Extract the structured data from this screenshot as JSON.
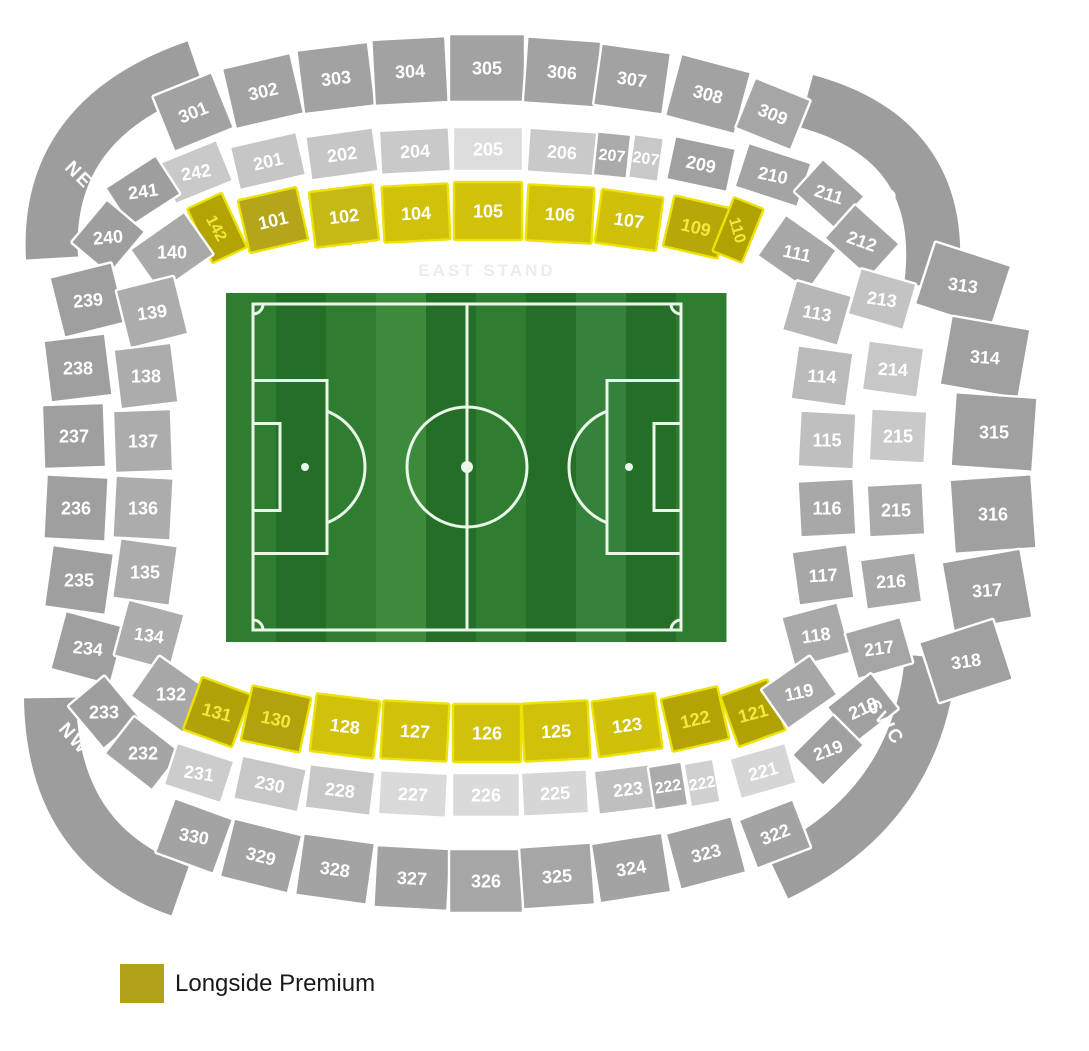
{
  "legend": {
    "label": "Longside Premium",
    "color": "#b2a219"
  },
  "stand_label": {
    "text": "EAST STAND",
    "x": 487,
    "y": 276,
    "color": "#ececec"
  },
  "palette": {
    "background": "#ffffff",
    "divider": "#ffffff",
    "section_text": "#ffffff",
    "yellow_bright": "#d0c10b",
    "yellow_dark": "#b1a204",
    "yellow_stroke": "#ece205",
    "yellow_text": "#f3e83c",
    "corner_band": "#9d9d9d"
  },
  "corner_labels": [
    {
      "label": "NEC",
      "x": 85,
      "y": 180,
      "r": 45
    },
    {
      "label": "SEC",
      "x": 880,
      "y": 185,
      "r": 50
    },
    {
      "label": "NWC",
      "x": 80,
      "y": 744,
      "r": 48
    },
    {
      "label": "SWC",
      "x": 886,
      "y": 722,
      "r": 55
    }
  ],
  "corner_bands": [
    {
      "name": "NEC",
      "d": "M 52 258 Q 44 118 196 66",
      "w": 52
    },
    {
      "name": "SEC",
      "d": "M 806 101 Q 950 140 931 287",
      "w": 54
    },
    {
      "name": "NWC",
      "d": "M 50 698 Q 52 846 180 891",
      "w": 52
    },
    {
      "name": "SWC",
      "d": "M 931 657 Q 918 808 777 875",
      "w": 52
    }
  ],
  "sections_columns": [
    "label",
    "x",
    "y",
    "w",
    "h",
    "rot",
    "label_rot",
    "fill",
    "cls"
  ],
  "sections": [
    [
      "301",
      193,
      112,
      64,
      60,
      -22,
      -22,
      "#a2a2a2",
      "gray"
    ],
    [
      "302",
      263,
      91,
      70,
      62,
      -13,
      -13,
      "#a2a2a2",
      "gray"
    ],
    [
      "303",
      336,
      78,
      72,
      64,
      -7,
      -7,
      "#a2a2a2",
      "gray"
    ],
    [
      "304",
      410,
      71,
      74,
      66,
      -3,
      -3,
      "#a2a2a2",
      "gray"
    ],
    [
      "305",
      487,
      68,
      76,
      68,
      0,
      0,
      "#a2a2a2",
      "gray"
    ],
    [
      "306",
      562,
      72,
      74,
      66,
      4,
      4,
      "#a2a2a2",
      "gray"
    ],
    [
      "307",
      632,
      79,
      70,
      62,
      8,
      8,
      "#a2a2a2",
      "gray"
    ],
    [
      "308",
      708,
      94,
      72,
      64,
      15,
      15,
      "#a2a2a2",
      "gray"
    ],
    [
      "309",
      773,
      114,
      60,
      54,
      22,
      22,
      "#a6a6a6",
      "gray"
    ],
    [
      "242",
      196,
      172,
      62,
      44,
      -22,
      -10,
      "#c9c9c9",
      "gray"
    ],
    [
      "201",
      268,
      161,
      68,
      44,
      -13,
      -13,
      "#c6c6c6",
      "gray"
    ],
    [
      "202",
      342,
      154,
      68,
      44,
      -8,
      -8,
      "#c6c6c6",
      "gray"
    ],
    [
      "204",
      415,
      151,
      70,
      44,
      -3,
      -3,
      "#c9c9c9",
      "gray"
    ],
    [
      "205",
      488,
      149,
      70,
      44,
      0,
      0,
      "#dcdcdc",
      "gray"
    ],
    [
      "206",
      562,
      152,
      68,
      44,
      4,
      4,
      "#c9c9c9",
      "gray"
    ],
    [
      "207",
      612,
      155,
      34,
      44,
      6,
      6,
      "#aaaaaa",
      "gray"
    ],
    [
      "207",
      646,
      158,
      30,
      44,
      8,
      8,
      "#c8c8c8",
      "gray"
    ],
    [
      "209",
      701,
      164,
      62,
      44,
      12,
      12,
      "#a0a0a0",
      "gray"
    ],
    [
      "210",
      773,
      175,
      66,
      46,
      18,
      12,
      "#a4a4a4",
      "gray"
    ],
    [
      "211",
      829,
      194,
      56,
      44,
      42,
      18,
      "#a4a4a4",
      "gray"
    ],
    [
      "142",
      217,
      228,
      38,
      60,
      -25,
      62,
      "#b3a404",
      "ylwd"
    ],
    [
      "101",
      273,
      220,
      60,
      54,
      -13,
      -13,
      "#b4a51a",
      "ylw"
    ],
    [
      "102",
      344,
      216,
      64,
      56,
      -7,
      -7,
      "#c6b815",
      "ylw"
    ],
    [
      "104",
      416,
      213,
      66,
      56,
      -3,
      -3,
      "#d0c10b",
      "ylw"
    ],
    [
      "105",
      488,
      211,
      68,
      58,
      0,
      0,
      "#d0c10b",
      "ylw"
    ],
    [
      "106",
      560,
      214,
      66,
      56,
      3,
      3,
      "#d0c10b",
      "ylw"
    ],
    [
      "107",
      629,
      220,
      62,
      54,
      8,
      8,
      "#cfc009",
      "ylw"
    ],
    [
      "109",
      696,
      227,
      56,
      52,
      13,
      13,
      "#b7a808",
      "ylwd"
    ],
    [
      "110",
      738,
      230,
      32,
      58,
      22,
      74,
      "#b1a204",
      "ylwd"
    ],
    [
      "241",
      143,
      191,
      60,
      46,
      -33,
      -8,
      "#9e9e9e",
      "gray"
    ],
    [
      "240",
      108,
      237,
      56,
      50,
      -50,
      -5,
      "#9e9e9e",
      "gray"
    ],
    [
      "140",
      172,
      252,
      66,
      52,
      -35,
      0,
      "#a9a9a9",
      "gray"
    ],
    [
      "239",
      88,
      300,
      64,
      62,
      -14,
      -5,
      "#9f9f9f",
      "gray"
    ],
    [
      "139",
      152,
      312,
      60,
      60,
      -14,
      -8,
      "#acacac",
      "gray"
    ],
    [
      "238",
      78,
      368,
      62,
      62,
      -7,
      0,
      "#9f9f9f",
      "gray"
    ],
    [
      "138",
      146,
      376,
      58,
      60,
      -7,
      0,
      "#acacac",
      "gray"
    ],
    [
      "237",
      74,
      436,
      62,
      64,
      -2,
      0,
      "#9f9f9f",
      "gray"
    ],
    [
      "137",
      143,
      441,
      58,
      62,
      -2,
      0,
      "#acacac",
      "gray"
    ],
    [
      "236",
      76,
      508,
      62,
      64,
      3,
      0,
      "#9f9f9f",
      "gray"
    ],
    [
      "136",
      143,
      508,
      58,
      62,
      3,
      0,
      "#acacac",
      "gray"
    ],
    [
      "235",
      79,
      580,
      62,
      62,
      8,
      0,
      "#9f9f9f",
      "gray"
    ],
    [
      "135",
      145,
      572,
      58,
      60,
      8,
      0,
      "#acacac",
      "gray"
    ],
    [
      "234",
      88,
      648,
      62,
      60,
      15,
      6,
      "#9f9f9f",
      "gray"
    ],
    [
      "134",
      149,
      635,
      58,
      58,
      15,
      8,
      "#acacac",
      "gray"
    ],
    [
      "233",
      104,
      712,
      56,
      48,
      50,
      0,
      "#9e9e9e",
      "gray"
    ],
    [
      "232",
      143,
      753,
      60,
      48,
      38,
      0,
      "#a4a4a4",
      "gray"
    ],
    [
      "132",
      171,
      694,
      64,
      50,
      35,
      0,
      "#a7a7a7",
      "gray"
    ],
    [
      "131",
      217,
      712,
      52,
      56,
      20,
      15,
      "#b1a20a",
      "ylwd"
    ],
    [
      "130",
      276,
      719,
      60,
      56,
      12,
      12,
      "#b2a30c",
      "ylwd"
    ],
    [
      "128",
      345,
      726,
      64,
      58,
      7,
      7,
      "#d0c10b",
      "ylw"
    ],
    [
      "127",
      415,
      731,
      66,
      58,
      3,
      3,
      "#d0c10b",
      "ylw"
    ],
    [
      "126",
      487,
      733,
      68,
      58,
      0,
      0,
      "#d0c10b",
      "ylw"
    ],
    [
      "125",
      556,
      731,
      66,
      58,
      -3,
      -3,
      "#d0c10b",
      "ylw"
    ],
    [
      "123",
      627,
      725,
      64,
      56,
      -8,
      -8,
      "#cfc009",
      "ylw"
    ],
    [
      "122",
      695,
      719,
      58,
      54,
      -13,
      -13,
      "#b3a404",
      "ylwd"
    ],
    [
      "121",
      753,
      713,
      50,
      54,
      -20,
      -15,
      "#b1a204",
      "ylwd"
    ],
    [
      "231",
      199,
      773,
      60,
      44,
      18,
      8,
      "#cccccc",
      "gray"
    ],
    [
      "230",
      270,
      784,
      66,
      44,
      12,
      12,
      "#c7c7c7",
      "gray"
    ],
    [
      "228",
      340,
      790,
      66,
      44,
      7,
      7,
      "#c7c7c7",
      "gray"
    ],
    [
      "227",
      413,
      794,
      68,
      44,
      3,
      3,
      "#dadada",
      "gray"
    ],
    [
      "226",
      486,
      795,
      68,
      44,
      0,
      0,
      "#dadada",
      "gray"
    ],
    [
      "225",
      555,
      793,
      66,
      44,
      -3,
      -3,
      "#d6d6d6",
      "gray"
    ],
    [
      "223",
      628,
      789,
      64,
      44,
      -7,
      -7,
      "#bfbfbf",
      "gray"
    ],
    [
      "222",
      668,
      786,
      34,
      44,
      -9,
      -9,
      "#ababab",
      "gray"
    ],
    [
      "222",
      702,
      783,
      30,
      44,
      -10,
      -10,
      "#d0d0d0",
      "gray"
    ],
    [
      "221",
      763,
      771,
      58,
      42,
      -16,
      -16,
      "#d6d6d6",
      "gray"
    ],
    [
      "330",
      194,
      836,
      62,
      58,
      20,
      10,
      "#a3a3a3",
      "gray"
    ],
    [
      "329",
      261,
      856,
      70,
      60,
      14,
      14,
      "#a3a3a3",
      "gray"
    ],
    [
      "328",
      335,
      869,
      72,
      62,
      8,
      8,
      "#a3a3a3",
      "gray"
    ],
    [
      "327",
      412,
      878,
      74,
      62,
      3,
      3,
      "#a3a3a3",
      "gray"
    ],
    [
      "326",
      486,
      881,
      74,
      64,
      0,
      0,
      "#a6a6a6",
      "gray"
    ],
    [
      "325",
      557,
      876,
      72,
      62,
      -4,
      -4,
      "#a6a6a6",
      "gray"
    ],
    [
      "324",
      631,
      868,
      72,
      60,
      -9,
      -9,
      "#a3a3a3",
      "gray"
    ],
    [
      "323",
      706,
      853,
      68,
      58,
      -15,
      -15,
      "#a3a3a3",
      "gray"
    ],
    [
      "322",
      775,
      834,
      58,
      52,
      -21,
      -21,
      "#a3a3a3",
      "gray"
    ],
    [
      "111",
      797,
      253,
      62,
      50,
      35,
      12,
      "#a7a7a7",
      "gray"
    ],
    [
      "113",
      817,
      313,
      58,
      52,
      16,
      10,
      "#b7b7b7",
      "gray"
    ],
    [
      "114",
      822,
      376,
      56,
      54,
      8,
      3,
      "#bbbbbb",
      "gray"
    ],
    [
      "115",
      827,
      440,
      56,
      56,
      3,
      0,
      "#bfbfbf",
      "gray"
    ],
    [
      "116",
      827,
      508,
      56,
      56,
      -3,
      0,
      "#a8a8a8",
      "gray"
    ],
    [
      "117",
      823,
      575,
      56,
      54,
      -8,
      -3,
      "#a6a6a6",
      "gray"
    ],
    [
      "118",
      816,
      635,
      58,
      52,
      -15,
      -8,
      "#a9a9a9",
      "gray"
    ],
    [
      "119",
      799,
      692,
      60,
      48,
      -35,
      -12,
      "#a7a7a7",
      "gray"
    ],
    [
      "212",
      862,
      241,
      60,
      46,
      42,
      20,
      "#a4a4a4",
      "gray"
    ],
    [
      "213",
      882,
      299,
      58,
      48,
      16,
      8,
      "#c3c3c3",
      "gray"
    ],
    [
      "214",
      893,
      369,
      56,
      50,
      8,
      3,
      "#c7c7c7",
      "gray"
    ],
    [
      "215",
      898,
      436,
      56,
      52,
      3,
      0,
      "#c9c9c9",
      "gray"
    ],
    [
      "215",
      896,
      510,
      56,
      52,
      -3,
      0,
      "#aaaaaa",
      "gray"
    ],
    [
      "216",
      891,
      581,
      56,
      50,
      -8,
      -3,
      "#a8a8a8",
      "gray"
    ],
    [
      "217",
      879,
      648,
      58,
      48,
      -16,
      -8,
      "#a5a5a5",
      "gray"
    ],
    [
      "218",
      863,
      708,
      56,
      46,
      -38,
      -25,
      "#a0a0a0",
      "gray"
    ],
    [
      "219",
      828,
      750,
      58,
      44,
      -45,
      -20,
      "#a0a0a0",
      "gray"
    ],
    [
      "313",
      963,
      285,
      80,
      66,
      18,
      8,
      "#a0a0a0",
      "gray"
    ],
    [
      "314",
      985,
      357,
      80,
      70,
      10,
      4,
      "#a0a0a0",
      "gray"
    ],
    [
      "315",
      994,
      432,
      82,
      74,
      4,
      0,
      "#a0a0a0",
      "gray"
    ],
    [
      "316",
      993,
      514,
      82,
      74,
      -4,
      0,
      "#a0a0a0",
      "gray"
    ],
    [
      "317",
      987,
      590,
      80,
      70,
      -10,
      -4,
      "#a0a0a0",
      "gray"
    ],
    [
      "318",
      966,
      661,
      78,
      64,
      -18,
      -8,
      "#a0a0a0",
      "gray"
    ]
  ],
  "pitch": {
    "x": 226,
    "y": 293,
    "w": 500,
    "h": 349,
    "stripe_colors": [
      "#2e7d31",
      "#256e28",
      "#2e7d31",
      "#3c8a3c",
      "#256e28",
      "#2e7d31",
      "#256e28",
      "#35833a",
      "#256e28",
      "#2e7d31"
    ],
    "line_color": "#e9f6e9",
    "boundary": {
      "x": 253,
      "y": 304,
      "w": 428,
      "h": 326
    },
    "center_circle_r": 60,
    "penalty_box": {
      "w": 74,
      "h": 173
    },
    "goal_box": {
      "w": 27,
      "h": 87
    },
    "spot_dx": 52,
    "penalty_arc_r": 60,
    "corner_arc_r": 10
  }
}
